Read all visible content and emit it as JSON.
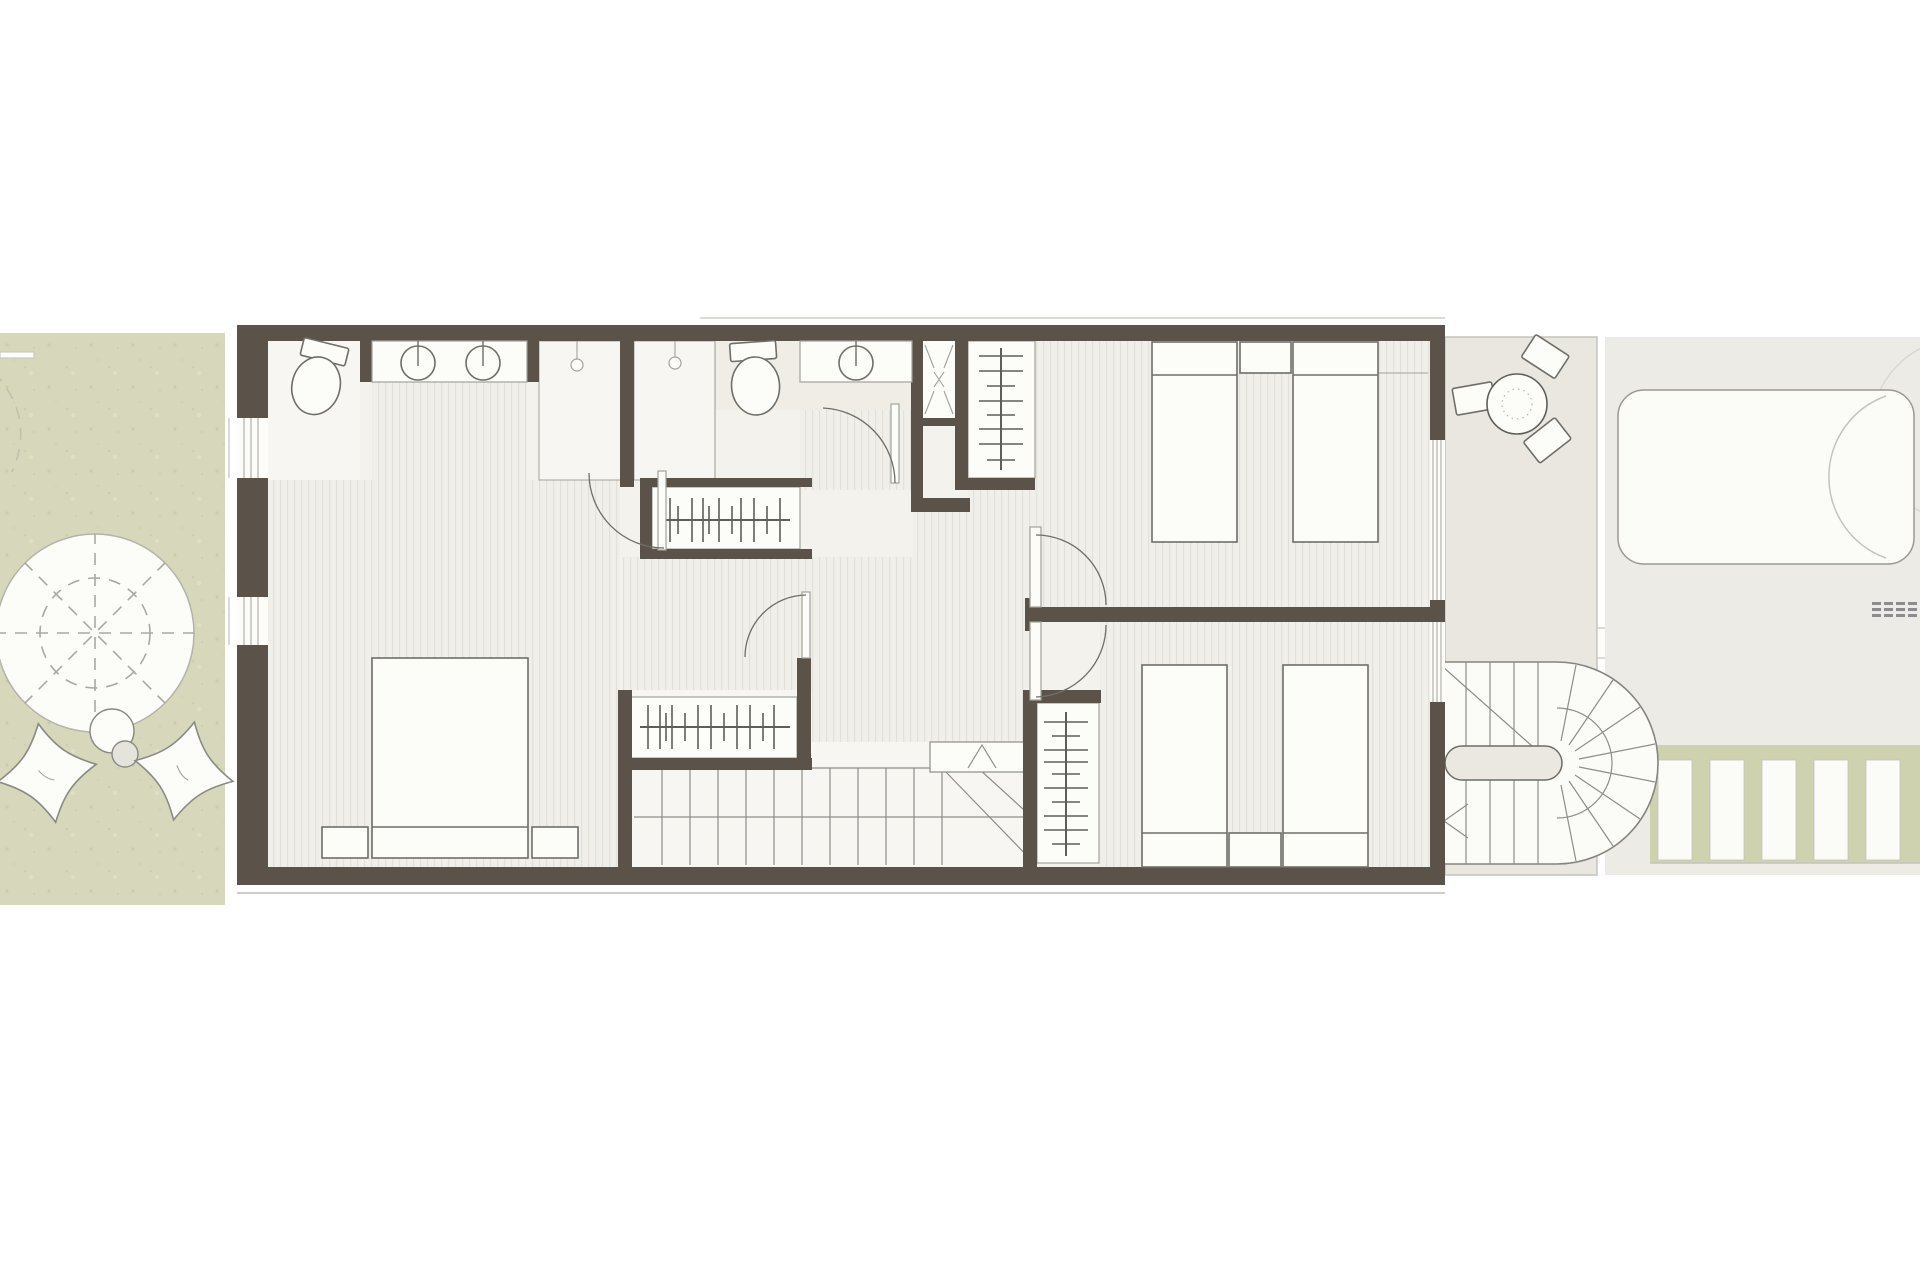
{
  "colors": {
    "wall": "#5b5349",
    "floor": "#f4f2ed",
    "floorLight": "#f7f6f2",
    "bath": "#efede6",
    "stripeBase": "#f1efe9",
    "stripeLine": "#e3e1d9",
    "white": "#fcfcf9",
    "garden": "#d7d8bb",
    "gardenDot": "#c3c6a2",
    "terrace": "#e9e7e0",
    "farZone": "#edebe5",
    "deckGreen": "#ced2ae",
    "pool": "#fbfbf8",
    "stroke": "#6f6f68",
    "thin": "#a3a29a",
    "faint": "#c5c4bc",
    "tread": "#8f8e86",
    "dash": "#a9a9a1",
    "rail": "#5f5f58",
    "grate": "#8c8c8e",
    "white-bg": "#ffffff"
  },
  "elements": [
    {
      "name": "garden-tree",
      "count": 1
    },
    {
      "name": "butterfly-chair",
      "count": 2
    },
    {
      "name": "garden-side-table",
      "count": 1
    },
    {
      "name": "toilet",
      "count": 2
    },
    {
      "name": "washbasin",
      "count": 3
    },
    {
      "name": "shower-drain",
      "count": 2
    },
    {
      "name": "ventilation-shaft",
      "count": 1
    },
    {
      "name": "wardrobe-rail",
      "count": 4
    },
    {
      "name": "double-bed",
      "count": 1
    },
    {
      "name": "single-bed",
      "count": 4
    },
    {
      "name": "nightstand",
      "count": 4
    },
    {
      "name": "interior-staircase",
      "count": 1
    },
    {
      "name": "spiral-staircase",
      "count": 1
    },
    {
      "name": "terrace-table",
      "count": 1
    },
    {
      "name": "terrace-stool",
      "count": 3
    },
    {
      "name": "pool-daybed",
      "count": 1
    },
    {
      "name": "deck-slats",
      "count": 1
    },
    {
      "name": "door-swing",
      "count": 5
    },
    {
      "name": "window",
      "count": 4
    }
  ]
}
